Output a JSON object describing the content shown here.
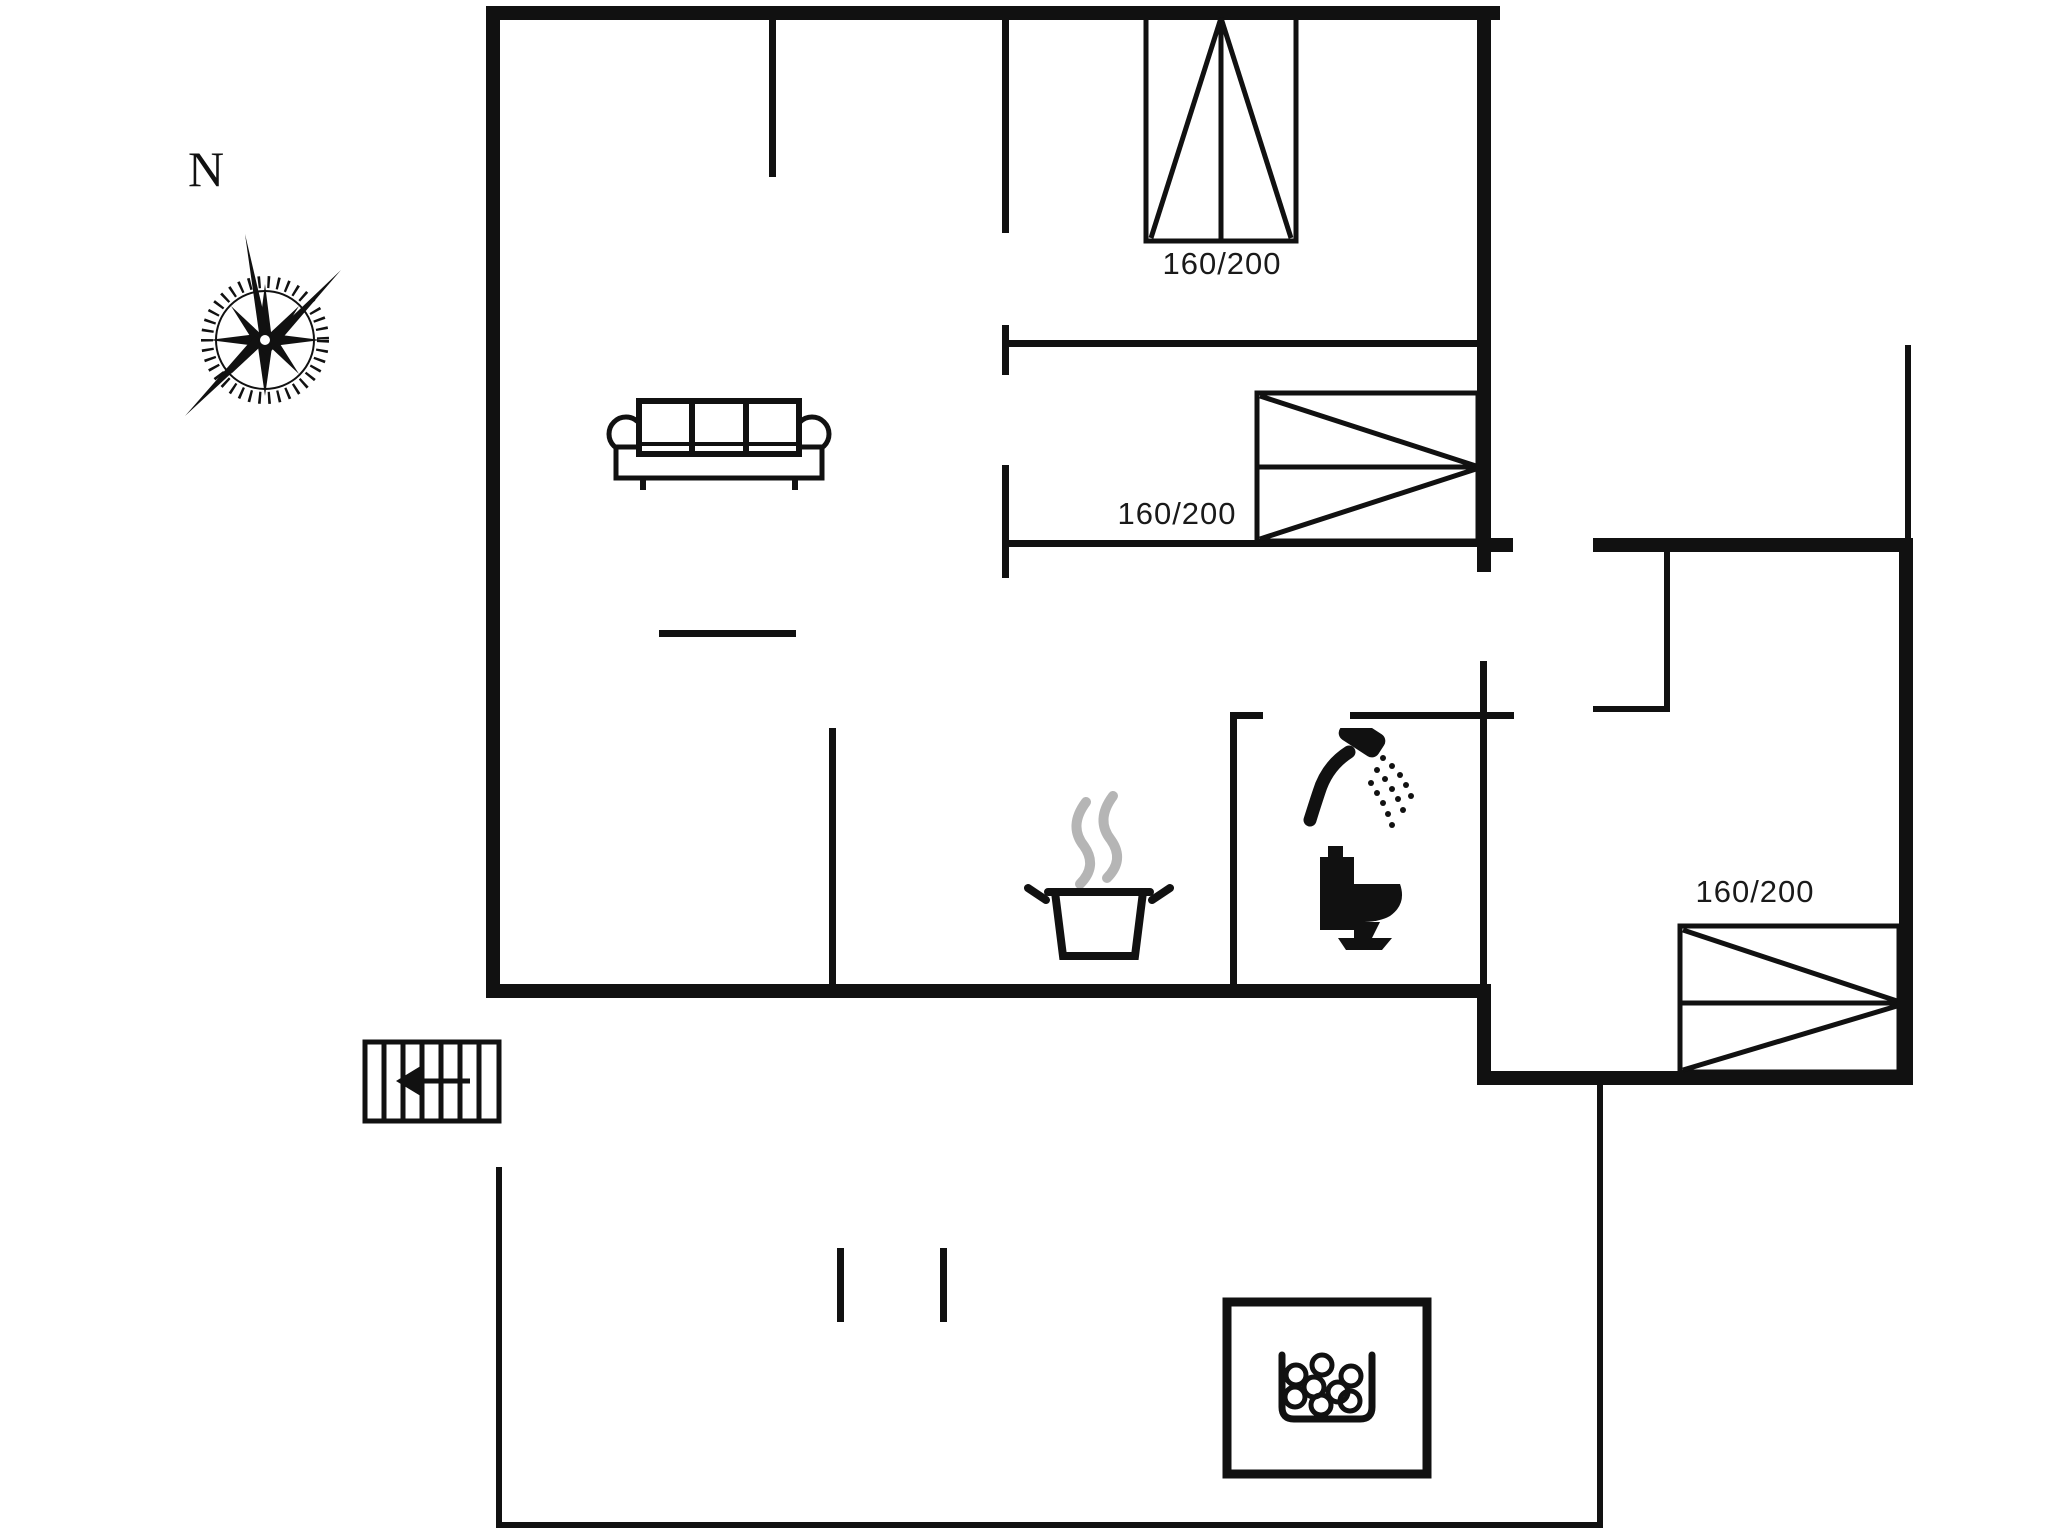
{
  "plan": {
    "compass": {
      "label": "N"
    },
    "beds": [
      {
        "id": "bed-top-bedroom",
        "label": "160/200"
      },
      {
        "id": "bed-mid-bedroom",
        "label": "160/200"
      },
      {
        "id": "bed-annex-bedroom",
        "label": "160/200"
      }
    ],
    "colors": {
      "wall": "#111111",
      "line": "#1a1a1a",
      "steam": "#b5b5b5",
      "background": "#ffffff"
    },
    "symbols": [
      "compass-rose",
      "double-bed-vertical",
      "double-bed-horizontal",
      "double-bed-horizontal",
      "sofa",
      "cooking-pot-steam",
      "shower-head",
      "toilet",
      "entry-stairs",
      "hot-tub-bubbles"
    ]
  }
}
